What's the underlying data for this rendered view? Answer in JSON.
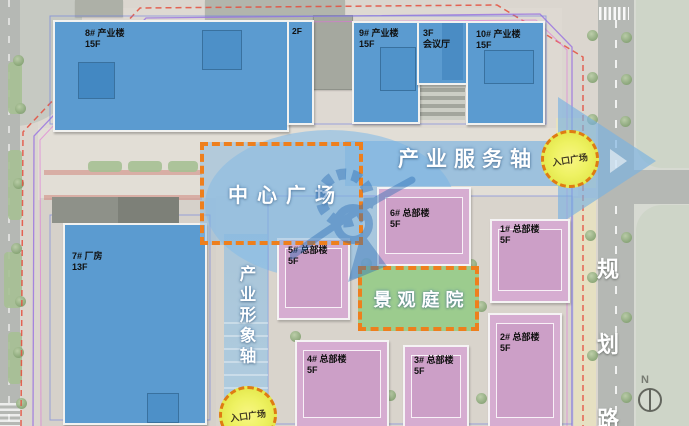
{
  "buildings": {
    "industrial": [
      {
        "line1": "8# 产业楼",
        "line2": "15F"
      },
      {
        "line1": "2F",
        "line2": ""
      },
      {
        "line1": "9# 产业楼",
        "line2": "15F"
      },
      {
        "line1": "3F",
        "line2": "会议厅"
      },
      {
        "line1": "10# 产业楼",
        "line2": "15F"
      },
      {
        "line1": "7# 厂房",
        "line2": "13F"
      }
    ],
    "headquarters": [
      {
        "line1": "1# 总部楼",
        "line2": "5F"
      },
      {
        "line1": "2# 总部楼",
        "line2": "5F"
      },
      {
        "line1": "3# 总部楼",
        "line2": "5F"
      },
      {
        "line1": "4# 总部楼",
        "line2": "5F"
      },
      {
        "line1": "5# 总部楼",
        "line2": "5F"
      },
      {
        "line1": "6# 总部楼",
        "line2": "5F"
      }
    ]
  },
  "axes": {
    "service_axis": "产业服务轴",
    "image_axis": "产业形象轴",
    "planning_road_chars": [
      "规",
      "划",
      "路"
    ]
  },
  "zones": {
    "central_plaza": "中心广场",
    "landscape_courtyard": "景观庭院",
    "entry_plaza_top": "入口广场",
    "entry_plaza_bottom": "入口广场"
  },
  "compass": {
    "north_label": "N"
  },
  "colors": {
    "accent_orange": "#ee7f1d",
    "industrial_blue": "#5b9bd0",
    "headquarters_pink": "#d6add1",
    "axis_blue": "#7ab2de",
    "courtyard_green": "#9ccc8e",
    "entry_yellow": "#eef263"
  }
}
